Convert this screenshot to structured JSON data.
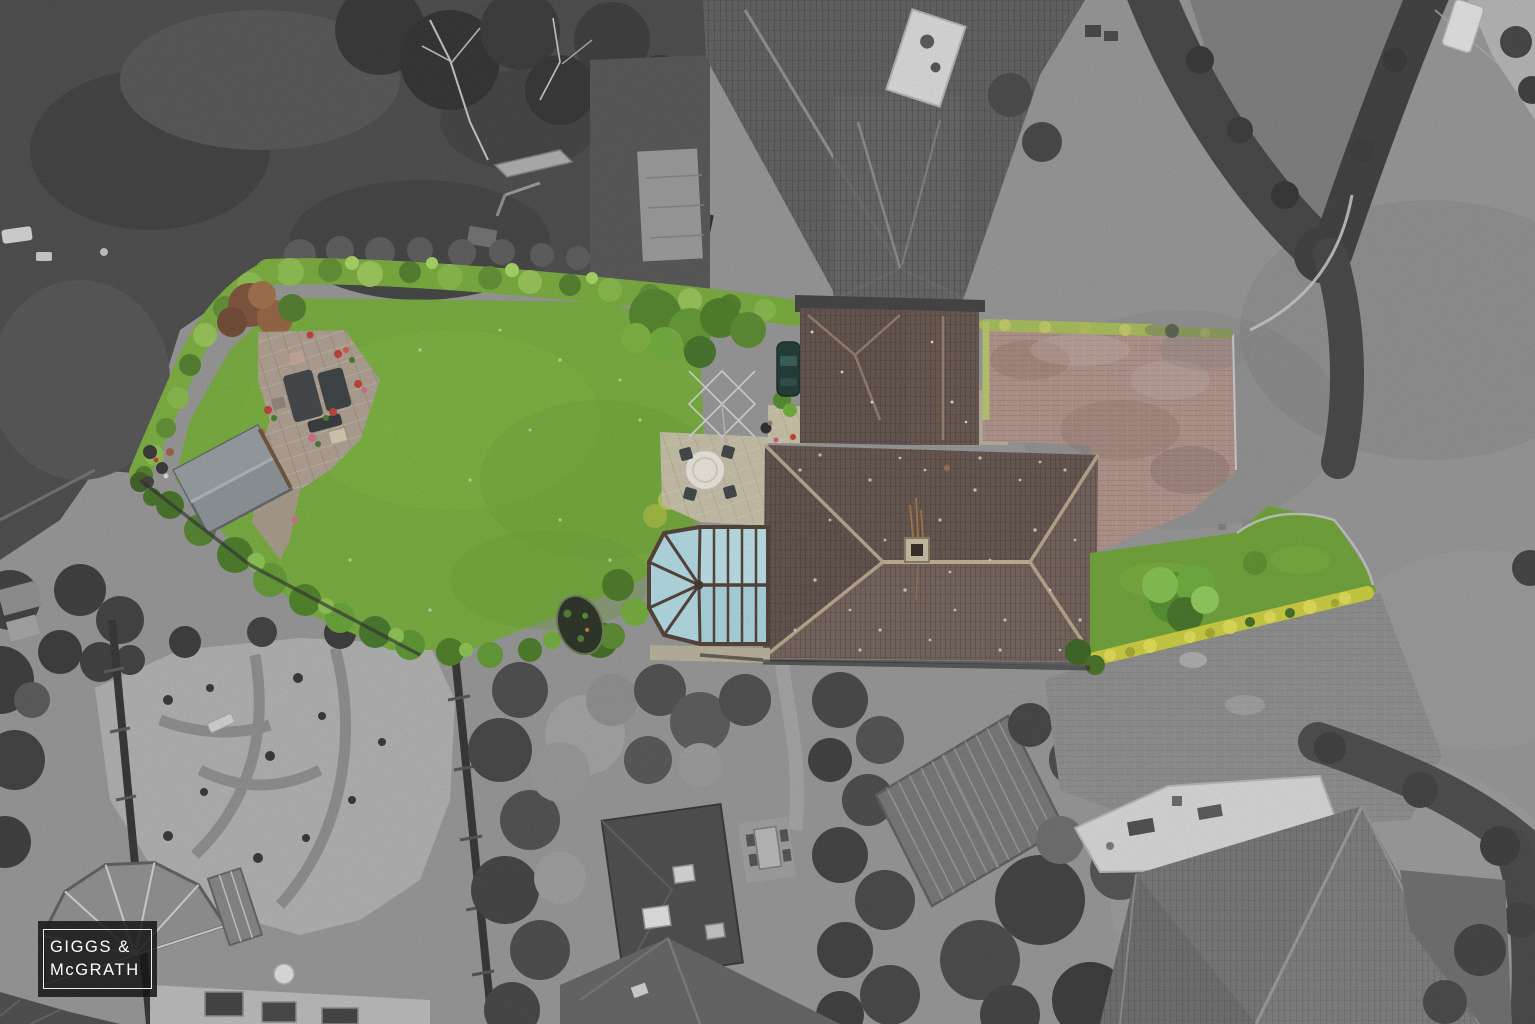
{
  "watermark": {
    "line1": "GIGGS &",
    "line2": "McGRATH"
  },
  "colors": {
    "road_base": "#969696",
    "road_textured": "#8d8d8d",
    "dark_garden": "#464646",
    "gravel": "#b2b2b2",
    "neighbor_roof": "#5d5d5d",
    "neighbor_roof_2": "#757575",
    "white_flat_roof": "#dcdcdc",
    "hedge_gray": "#3f3f3f",
    "back_lawn": "#74ad36",
    "front_lawn": "#6ba331",
    "hedge_green": "#76ad36",
    "hedge_green_left": "#79b038",
    "yellow_hedge": "#cfd139",
    "main_roof": "#6a5850",
    "garage_roof": "#5f4e47",
    "garage_roof_2": "#64534b",
    "driveway_brick": "#b2938b",
    "driveway_hedge": "#a8bf56",
    "conservatory_glass_top": "#bde4ec",
    "conservatory_glass_bottom": "#a9d9e4",
    "conservatory_glass_apse": "#b4dfe9",
    "conservatory_frame": "#4c3a30",
    "patio_stone": "#b0a090",
    "pale_paving": "#cdc5a8",
    "shed_gray": "#8b9297",
    "pond_water": "#222b1d",
    "car_body": "#17332e",
    "watermark_bg": "rgba(22,22,22,0.85)"
  }
}
